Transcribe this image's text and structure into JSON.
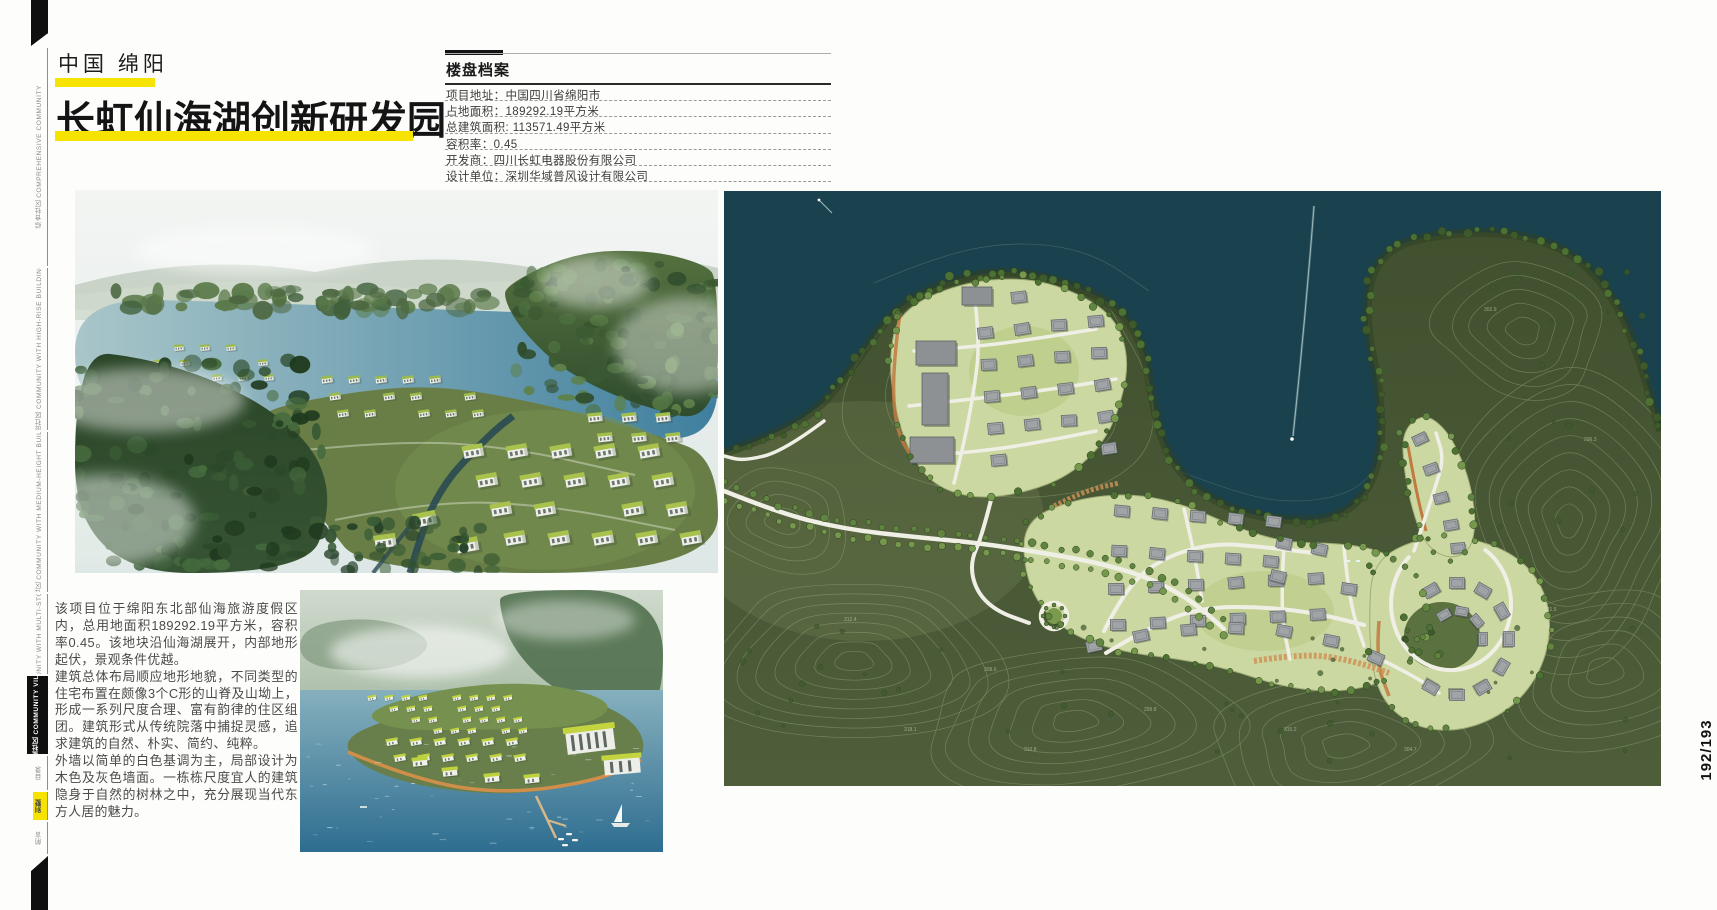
{
  "header": {
    "location": "中国  绵阳",
    "title": "长虹仙海湖创新研发园",
    "page_number": "192/193",
    "accent_color": "#f6e400"
  },
  "info_panel": {
    "title": "楼盘档案",
    "rows": [
      "项目地址：中国四川省绵阳市",
      "占地面积：189292.19平方米",
      "总建筑面积: 113571.49平方米",
      "容积率：0.45",
      "开发商：四川长虹电器股份有限公司",
      "设计单位：深圳华域普风设计有限公司"
    ]
  },
  "description": {
    "p1": "该项目位于绵阳东北部仙海旅游度假区内，总用地面积189292.19平方米，容积率0.45。该地块沿仙海湖展开，内部地形起伏，景观条件优越。",
    "p2": "建筑总体布局顺应地形地貌，不同类型的住宅布置在颇像3个C形的山脊及山坳上，形成一系列尺度合理、富有韵律的住区组团。建筑形式从传统院落中捕捉灵感，追求建筑的自然、朴实、简约、纯粹。",
    "p3": "外墙以简单的白色基调为主，局部设计为木色及灰色墙面。一栋栋尺度宜人的建筑隐身于自然的树林之中，充分展现当代东方人居的魅力。"
  },
  "spine": {
    "tabs": [
      {
        "label": "综合社区 COMPREHENSIVE COMMUNITY",
        "active": false
      },
      {
        "label": "高层社区 COMMUNITY WITH HIGH-RISE BUILDINGS",
        "active": false
      },
      {
        "label": "小高层社区 COMMUNITY WITH MEDIUM-HEIGHT BUILDINGS",
        "active": false
      },
      {
        "label": "多层社区 COMMUNITY WITH MULTI-STORY BUILDINGS",
        "active": false
      },
      {
        "label": "别墅社区 COMMUNITY VILLA",
        "active": true
      }
    ],
    "bottom_tabs": [
      "目录",
      "别墅",
      "前言"
    ]
  },
  "masterplan": {
    "elevation_labels": [
      "312.4",
      "308.6",
      "299.8",
      "315.2",
      "304.7",
      "321.5",
      "296.3",
      "310.8",
      "318.1",
      "302.9"
    ]
  }
}
